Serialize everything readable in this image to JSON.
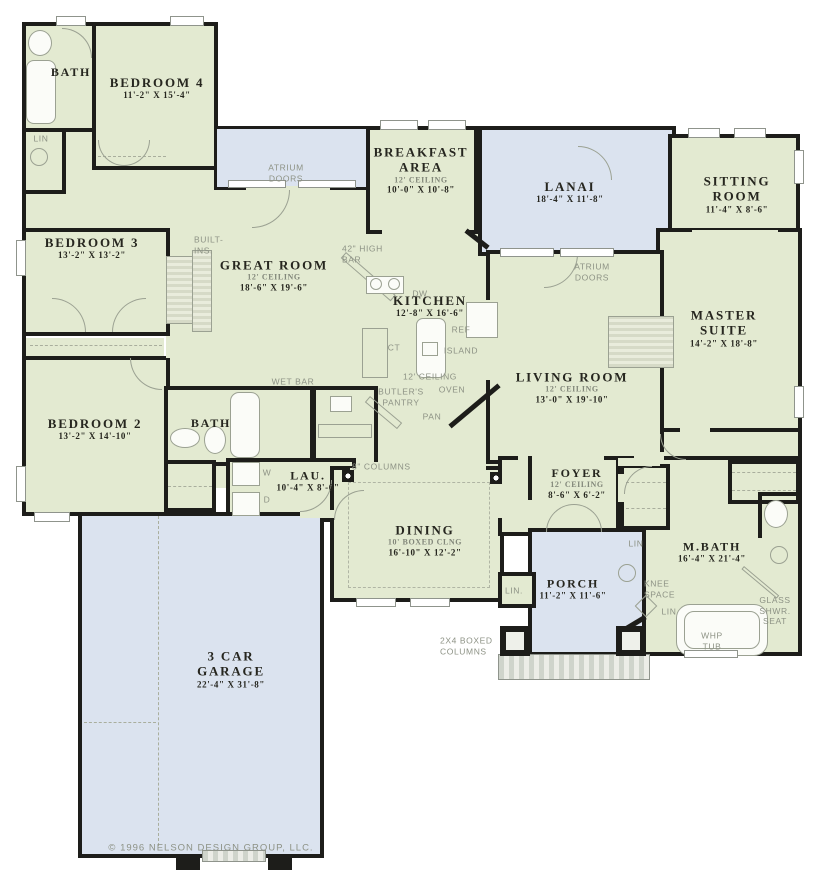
{
  "plan": {
    "copyright": "© 1996 NELSON DESIGN GROUP, LLC.",
    "colors": {
      "interior_green": "#e3ead1",
      "outdoor_blue": "#dbe3ef",
      "wall_black": "#1d1d1a",
      "annotation_gray": "#8d9285"
    },
    "rooms": {
      "bath1": {
        "name": "BATH"
      },
      "bedroom4": {
        "name": "BEDROOM 4",
        "dims": "11'-2\" X 15'-4\""
      },
      "bedroom3": {
        "name": "BEDROOM 3",
        "dims": "13'-2\" X 13'-2\""
      },
      "bedroom2": {
        "name": "BEDROOM 2",
        "dims": "13'-2\" X 14'-10\""
      },
      "great_room": {
        "name": "GREAT ROOM",
        "ceiling": "12' CEILING",
        "dims": "18'-6\" X 19'-6\""
      },
      "breakfast": {
        "name": "BREAKFAST AREA",
        "ceiling": "12' CEILING",
        "dims": "10'-0\" X 10'-8\""
      },
      "lanai": {
        "name": "LANAI",
        "dims": "18'-4\" X 11'-8\""
      },
      "sitting": {
        "name": "SITTING ROOM",
        "dims": "11'-4\" X 8'-6\""
      },
      "master": {
        "name": "MASTER SUITE",
        "dims": "14'-2\" X 18'-8\""
      },
      "kitchen": {
        "name": "KITCHEN",
        "dims": "12'-8\" X 16'-6\""
      },
      "living": {
        "name": "LIVING ROOM",
        "ceiling": "12' CEILING",
        "dims": "13'-0\" X 19'-10\""
      },
      "bath2": {
        "name": "BATH"
      },
      "laundry": {
        "name": "LAU.",
        "dims": "10'-4\" X 8'-6\""
      },
      "dining": {
        "name": "DINING",
        "ceiling": "10' BOXED CLNG",
        "dims": "16'-10\" X 12'-2\""
      },
      "foyer": {
        "name": "FOYER",
        "ceiling": "12' CEILING",
        "dims": "8'-6\" X 6'-2\""
      },
      "porch": {
        "name": "PORCH",
        "dims": "11'-2\" X 11'-6\""
      },
      "mbath": {
        "name": "M.BATH",
        "dims": "16'-4\" X 21'-4\""
      },
      "garage": {
        "name": "3 CAR GARAGE",
        "dims": "22'-4\" X 31'-8\""
      }
    },
    "annotations": {
      "atrium_doors_top": "ATRIUM DOORS",
      "atrium_doors_living": "ATRIUM DOORS",
      "built_ins": "BUILT- INS.",
      "high_bar": "42\" HIGH BAR",
      "dw": "DW",
      "ref": "REF",
      "ct": "CT",
      "island": "ISLAND",
      "ceiling12": "12' CEILING",
      "oven": "OVEN",
      "butlers_pantry": "BUTLER'S PANTRY",
      "pan": "PAN",
      "wet_bar": "WET BAR",
      "washer": "W",
      "dryer": "D",
      "columns_8": "8\" COLUMNS",
      "lin_hall": "LIN",
      "lin_dining": "LIN.",
      "lin_foyer": "LIN",
      "lin_mbath": "LIN",
      "knee_space": "KNEE SPACE",
      "glass_shwr": "GLASS SHWR. SEAT",
      "whp_tub": "WHP TUB",
      "boxed_columns": "2X4 BOXED COLUMNS"
    }
  }
}
